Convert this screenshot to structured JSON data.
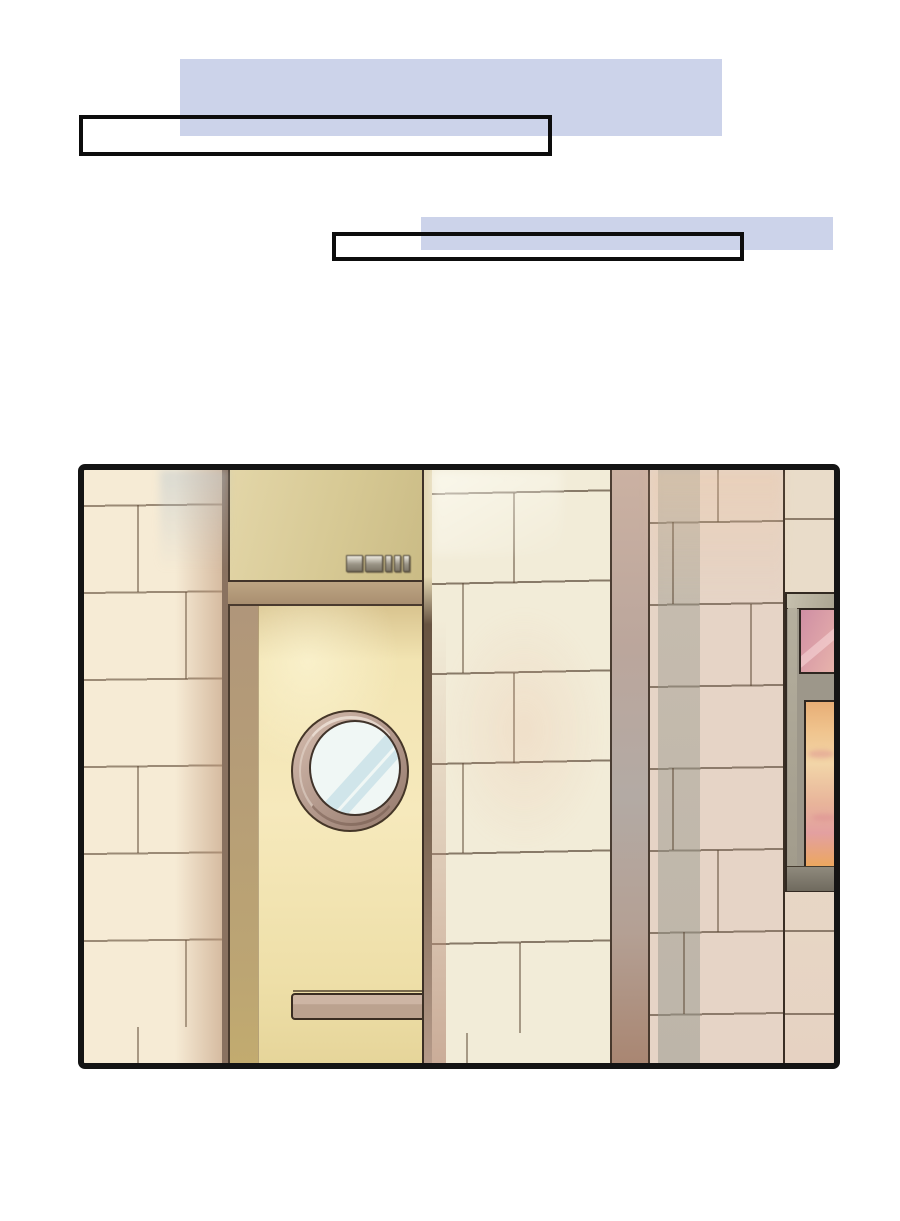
{
  "page": {
    "background_color": "#ffffff",
    "kind": "comic-page"
  },
  "dialogue": {
    "bubble1": {
      "text": "",
      "highlight_color": "#ccd3ea"
    },
    "bubble2": {
      "text": "",
      "highlight_color": "#ccd3ea"
    }
  },
  "panel": {
    "border_color": "#141414",
    "door_sign_text": "诊室101",
    "colors": {
      "wall_cream": "#f6ebd5",
      "wall_mid_cream": "#f2ecd8",
      "wall_right_pink": "#e6d4c6",
      "corner_strip": "#b4a094",
      "transom": "#d6c893",
      "door": "#f2e4b2",
      "door_frame": "#a98f70",
      "porthole_ring": "#b49a8d",
      "porthole_glass": "#f0f7f5",
      "push_plate": "#bfa795",
      "frame_grey": "#9d978a",
      "poster_pink": "#dda2a8",
      "poster_sunset": "#f0c48e",
      "highlight_lavender": "#ccd3ea"
    }
  }
}
